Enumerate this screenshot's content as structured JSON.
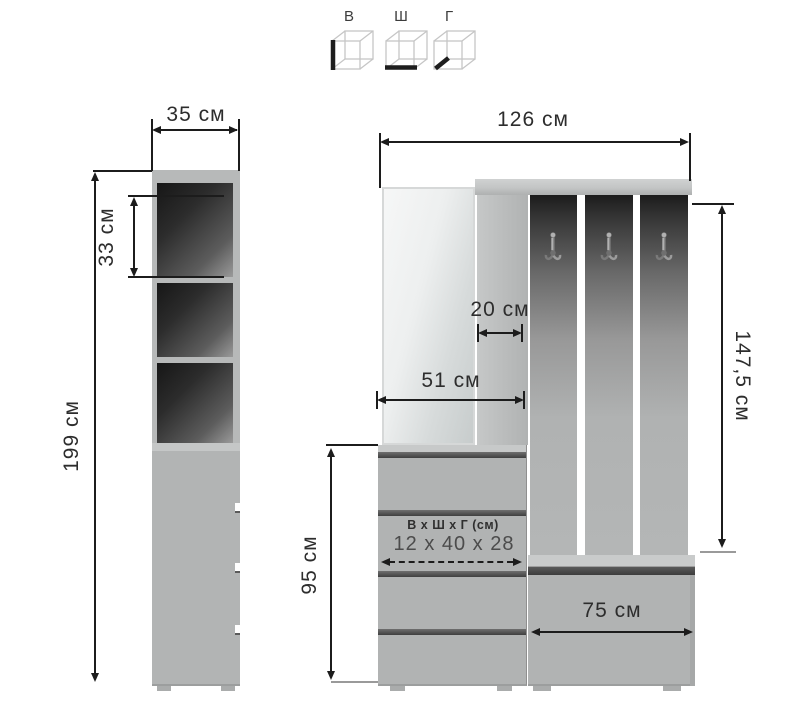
{
  "legend": {
    "height_label": "В",
    "width_label": "Ш",
    "depth_label": "Г"
  },
  "dimensions": {
    "tall_cabinet_width": "35 см",
    "tall_cabinet_shelf_height": "33 см",
    "tall_cabinet_height": "199 см",
    "wardrobe_width": "126 см",
    "side_panel_width": "20 см",
    "mirror_section_width": "51 см",
    "hook_section_height": "147,5 см",
    "drawer_section_height": "95 см",
    "bench_width": "75 см"
  },
  "drawer_spec": {
    "title": "В х Ш х Г (см)",
    "value": "12 x 40 x 28"
  },
  "icons": {
    "legend": [
      "height-cube-icon",
      "width-cube-icon",
      "depth-cube-icon"
    ],
    "hook": "coat-hook-icon"
  },
  "colors": {
    "background": "#ffffff",
    "furniture_gray": "#b1b3b3",
    "board_gray": "#c9cbcb",
    "niche_shadow": "#1c1c1c",
    "dimension_line": "#1c1c1c",
    "text": "#2d2d2d"
  }
}
